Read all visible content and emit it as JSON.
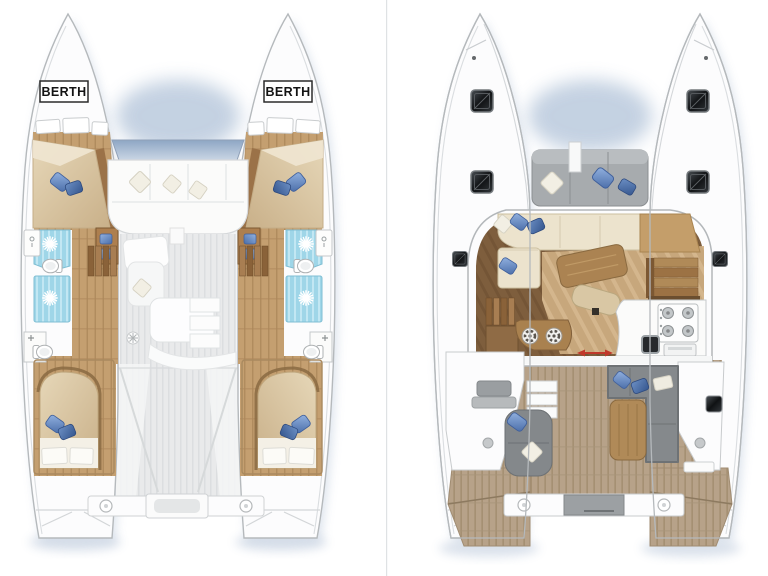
{
  "canvas": {
    "width": 768,
    "height": 576,
    "background": "#ffffff"
  },
  "labels": {
    "berth_port": "BERTH",
    "berth_starboard": "BERTH"
  },
  "views": {
    "lower_deck": {
      "name": "lower-deck-plan",
      "features": [
        "forward-berth-port",
        "forward-berth-starboard",
        "aft-double-bed-port",
        "aft-double-bed-starboard",
        "shower-head-x4",
        "toilet-x4",
        "washbasin-x4",
        "companionway-stairs-x2",
        "forward-cockpit-sofa",
        "saloon-furniture-footprint",
        "aft-deck",
        "transom-beam",
        "mooring-cleats"
      ]
    },
    "main_deck": {
      "name": "main-deck-plan",
      "features": [
        "deck-hatches-x6",
        "forward-sunpad",
        "saloon-l-sofa",
        "saloon-table",
        "ottoman",
        "galley-stove-4-burner",
        "galley-sink",
        "oven",
        "bar-stools-x2",
        "companionway-stairs-x2",
        "chart-desk",
        "sliding-door-arrow",
        "helm-seat",
        "side-steps",
        "cockpit-chaise",
        "cockpit-sofa",
        "cockpit-table",
        "transom-beam",
        "mooring-cleats",
        "teak-swim-steps",
        "mast-post"
      ]
    }
  },
  "colors": {
    "hull_fill": "#fcfcfd",
    "hull_outline": "#b5b9bc",
    "shadow_blue": "#aebfd6",
    "wood_floor": "#c49f70",
    "wood_dark": "#8a6239",
    "mattress_tan": "#d9c6a6",
    "bathroom_cyan": "#9fd6e8",
    "pillow_blue": "#6f93c8",
    "pillow_blue_dark": "#41659f",
    "cream_sofa": "#ece3cd",
    "saloon_floor_dark": "#7e5e3d",
    "saloon_floor_light": "#c7a77c",
    "teak_deck": "#b7a289",
    "gray_cushion": "#85898c",
    "hatch_black": "#17191c",
    "arrow_red": "#c0392b"
  }
}
